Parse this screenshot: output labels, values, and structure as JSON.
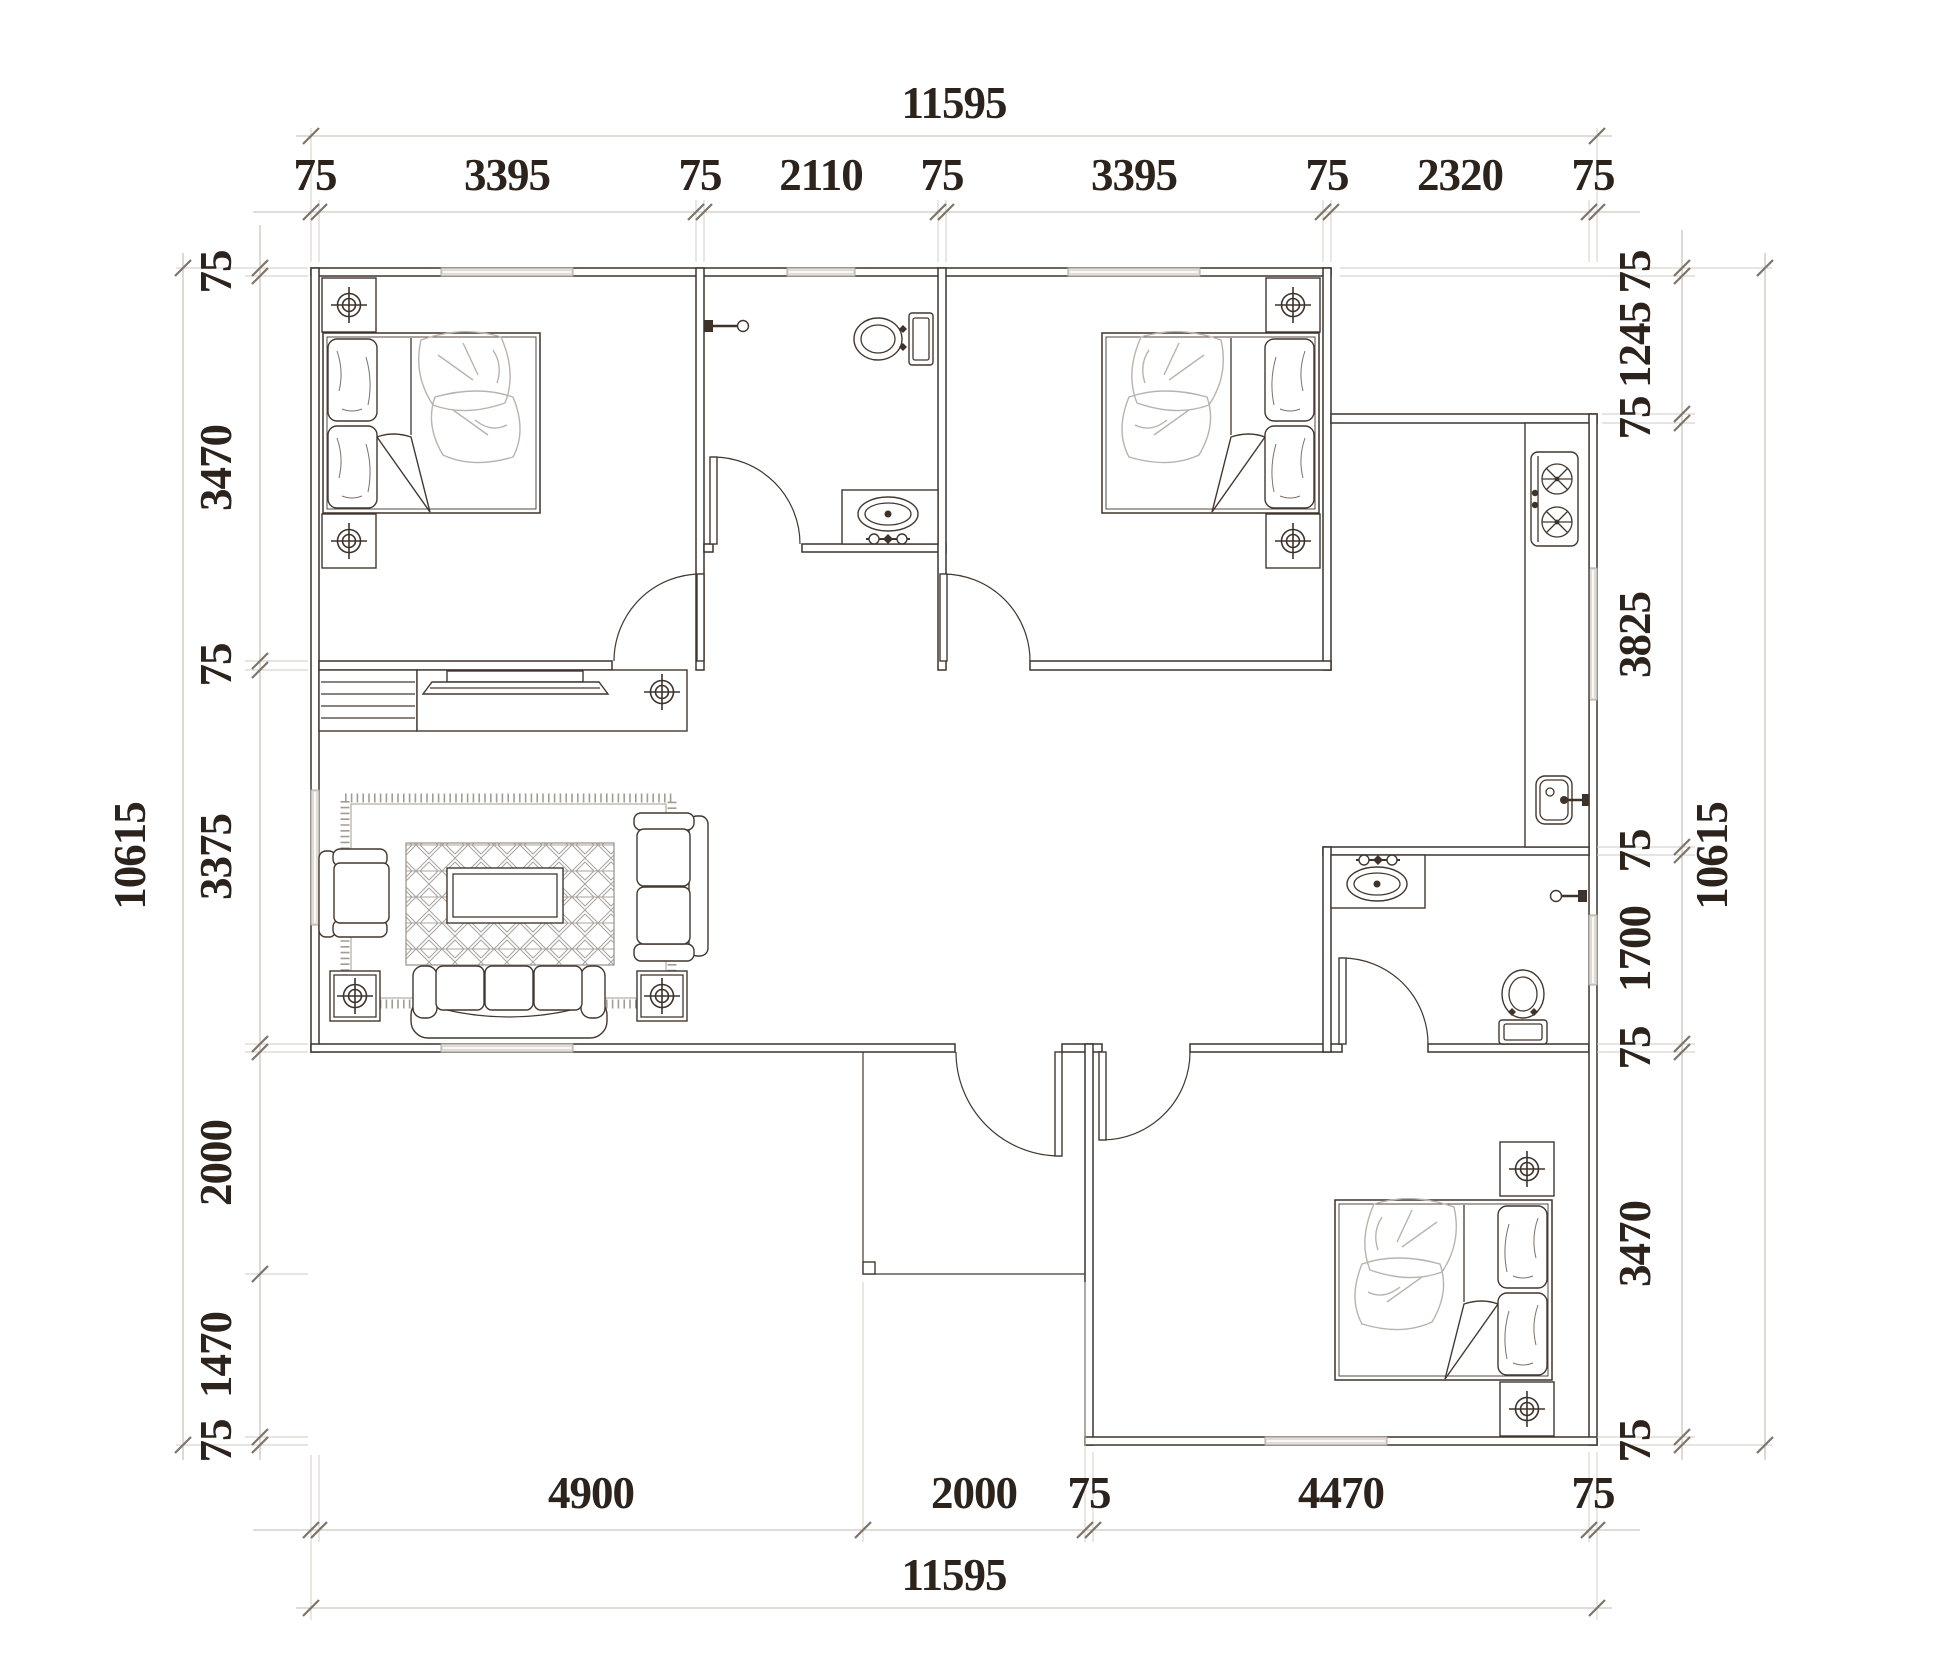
{
  "drawing": {
    "type": "architectural-floor-plan",
    "units": "mm",
    "line_color": "#3d332b",
    "dim_text_color": "#2c231c"
  },
  "dimensions": {
    "top": {
      "overall": "11595",
      "segments": [
        "75",
        "3395",
        "75",
        "2110",
        "75",
        "3395",
        "75",
        "2320",
        "75"
      ]
    },
    "bottom": {
      "overall": "11595",
      "segments": [
        "4900",
        "2000",
        "75",
        "4470",
        "75"
      ]
    },
    "left": {
      "overall": "10615",
      "segments": [
        "75",
        "3470",
        "75",
        "3375",
        "2000",
        "1470",
        "75"
      ]
    },
    "right": {
      "overall": "10615",
      "segments": [
        "75",
        "1245",
        "75",
        "3825",
        "75",
        "1700",
        "75",
        "3470",
        "75"
      ]
    }
  },
  "rooms": [
    {
      "id": "bedroom-top-left",
      "furniture": [
        "double-bed-icon",
        "nightstand-icon",
        "nightstand-icon",
        "door",
        "window"
      ]
    },
    {
      "id": "bathroom-top",
      "furniture": [
        "toilet-icon",
        "vanity-sink-icon",
        "shower-valve-icon",
        "door",
        "window"
      ]
    },
    {
      "id": "bedroom-top-right",
      "furniture": [
        "double-bed-icon",
        "nightstand-icon",
        "nightstand-icon",
        "door",
        "window"
      ]
    },
    {
      "id": "kitchen",
      "furniture": [
        "counter",
        "gas-stove-icon",
        "kitchen-sink-icon",
        "window"
      ]
    },
    {
      "id": "bathroom-right",
      "furniture": [
        "vanity-sink-icon",
        "toilet-icon",
        "towel-bar-icon",
        "door",
        "window"
      ]
    },
    {
      "id": "living-room",
      "furniture": [
        "louver-cabinet",
        "tv-cabinet",
        "tv-icon",
        "ceiling-target-icon",
        "rug",
        "coffee-table",
        "armchair-icon",
        "loveseat-icon",
        "sofa-icon",
        "side-table-icon",
        "side-table-icon",
        "window",
        "window"
      ]
    },
    {
      "id": "bedroom-bottom-right",
      "furniture": [
        "double-bed-icon",
        "nightstand-icon",
        "nightstand-icon",
        "door",
        "window"
      ]
    },
    {
      "id": "entry-porch",
      "furniture": [
        "entry-door",
        "porch-corner-post"
      ]
    }
  ]
}
